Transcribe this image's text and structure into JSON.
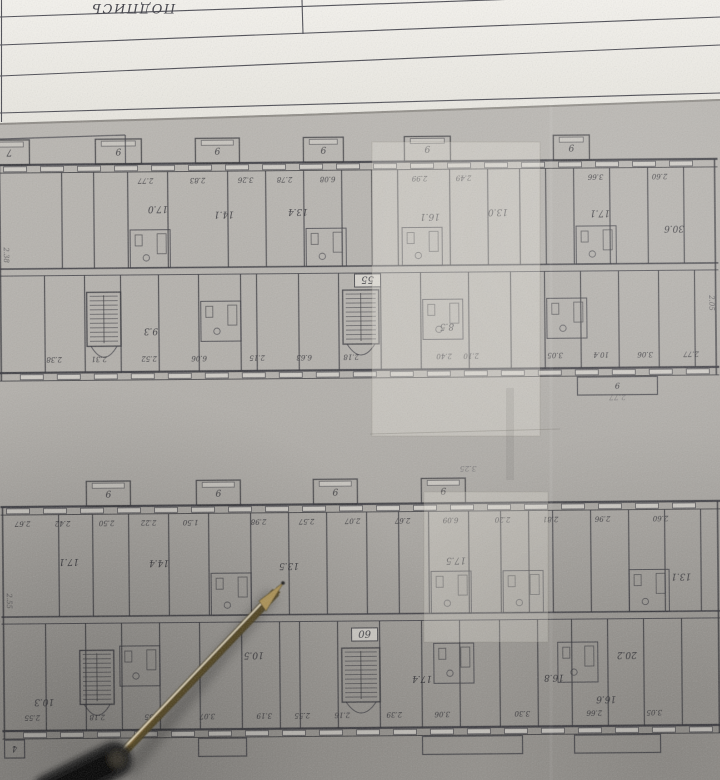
{
  "form_header": {
    "signature_label": "ПОДПИСЬ"
  },
  "colors": {
    "form_paper": "#f2f0ea",
    "photo_paper": "#b3b0ab",
    "ink": "#33333a",
    "patch": "#ece9e1",
    "pen_gold": "#c2a55e",
    "pen_grip": "#141414"
  },
  "plan": {
    "strips": [
      {
        "id": "upper",
        "y_top": 162,
        "y_mid": 266,
        "y_bottom": 370,
        "balconies_top": [
          {
            "x": -8,
            "w": 40,
            "label": "7"
          },
          {
            "x": 98,
            "w": 46,
            "label": "9"
          },
          {
            "x": 198,
            "w": 44,
            "label": "9"
          },
          {
            "x": 306,
            "w": 40,
            "label": "9"
          },
          {
            "x": 407,
            "w": 46,
            "label": "9"
          },
          {
            "x": 556,
            "w": 36,
            "label": "9"
          }
        ],
        "balconies_bottom": [
          {
            "x": 578,
            "w": 80,
            "label": "9"
          }
        ],
        "v_walls_upper": [
          64,
          96,
          130,
          170,
          230,
          268,
          306,
          344,
          374,
          400,
          452,
          490,
          522,
          548,
          576,
          612,
          650,
          686
        ],
        "v_walls_lower": [
          46,
          86,
          122,
          160,
          200,
          242,
          258,
          300,
          340,
          382,
          422,
          470,
          512,
          546,
          582,
          620,
          660,
          696
        ],
        "stairs": [
          {
            "x": 88,
            "y": 290,
            "w": 34,
            "h": 54
          },
          {
            "x": 344,
            "y": 290,
            "w": 36,
            "h": 54
          }
        ],
        "unit_box": {
          "x": 356,
          "y": 274,
          "w": 26,
          "h": 13,
          "label": "55"
        },
        "bath_clusters": [
          {
            "x": 132,
            "y": 228
          },
          {
            "x": 308,
            "y": 228
          },
          {
            "x": 404,
            "y": 228
          },
          {
            "x": 578,
            "y": 228
          },
          {
            "x": 202,
            "y": 300
          },
          {
            "x": 424,
            "y": 300
          },
          {
            "x": 548,
            "y": 300
          }
        ],
        "dim_labels_top": [
          {
            "x": 148,
            "t": "2.77"
          },
          {
            "x": 200,
            "t": "2.83"
          },
          {
            "x": 248,
            "t": "3.26"
          },
          {
            "x": 287,
            "t": "2.78"
          },
          {
            "x": 330,
            "t": "6.08"
          },
          {
            "x": 422,
            "t": "2.99"
          },
          {
            "x": 466,
            "t": "2.49"
          },
          {
            "x": 598,
            "t": "3.66"
          },
          {
            "x": 662,
            "t": "2.60"
          }
        ],
        "room_labels": [
          {
            "x": 160,
            "y": 208,
            "t": "17.0"
          },
          {
            "x": 226,
            "y": 214,
            "t": "14.1"
          },
          {
            "x": 300,
            "y": 212,
            "t": "13.4"
          },
          {
            "x": 432,
            "y": 218,
            "t": "16.1"
          },
          {
            "x": 500,
            "y": 214,
            "t": "13.0"
          },
          {
            "x": 602,
            "y": 216,
            "t": "17.1"
          },
          {
            "x": 676,
            "y": 232,
            "t": "30.6"
          },
          {
            "x": 152,
            "y": 330,
            "t": "9.3"
          },
          {
            "x": 448,
            "y": 328,
            "t": "8.5"
          }
        ],
        "dim_labels_bottom": [
          {
            "x": 55,
            "t": "2.38"
          },
          {
            "x": 100,
            "t": "2.31"
          },
          {
            "x": 150,
            "t": "2.52"
          },
          {
            "x": 200,
            "t": "6.06"
          },
          {
            "x": 258,
            "t": "2.15"
          },
          {
            "x": 305,
            "t": "6.63"
          },
          {
            "x": 352,
            "t": "2.18"
          },
          {
            "x": 445,
            "t": "2.40"
          },
          {
            "x": 472,
            "t": "2.10"
          },
          {
            "x": 556,
            "t": "3.05"
          },
          {
            "x": 602,
            "t": "10.4"
          },
          {
            "x": 646,
            "t": "3.06"
          },
          {
            "x": 692,
            "t": "2.77"
          }
        ]
      },
      {
        "id": "lower",
        "y_top": 504,
        "y_mid": 614,
        "y_bottom": 728,
        "balconies_top": [
          {
            "x": 86,
            "w": 44,
            "label": "9"
          },
          {
            "x": 196,
            "w": 44,
            "label": "9"
          },
          {
            "x": 313,
            "w": 44,
            "label": "9"
          },
          {
            "x": 421,
            "w": 44,
            "label": "9"
          }
        ],
        "balconies_bottom": [
          {
            "x": 2,
            "w": 20,
            "label": "4"
          },
          {
            "x": 196,
            "w": 48,
            "label": ""
          },
          {
            "x": 420,
            "w": 100,
            "label": ""
          },
          {
            "x": 572,
            "w": 86,
            "label": ""
          }
        ],
        "v_walls_upper": [
          58,
          92,
          128,
          168,
          208,
          250,
          288,
          326,
          366,
          398,
          428,
          468,
          500,
          528,
          552,
          590,
          628,
          664,
          700
        ],
        "v_walls_lower": [
          44,
          84,
          120,
          158,
          198,
          240,
          278,
          298,
          336,
          378,
          420,
          458,
          498,
          536,
          570,
          606,
          642,
          680
        ],
        "stairs": [
          {
            "x": 78,
            "y": 648,
            "w": 34,
            "h": 54
          },
          {
            "x": 340,
            "y": 648,
            "w": 38,
            "h": 54
          }
        ],
        "unit_box": {
          "x": 350,
          "y": 628,
          "w": 26,
          "h": 13,
          "label": "60"
        },
        "bath_clusters": [
          {
            "x": 210,
            "y": 572
          },
          {
            "x": 430,
            "y": 572
          },
          {
            "x": 502,
            "y": 572
          },
          {
            "x": 628,
            "y": 572
          },
          {
            "x": 118,
            "y": 644
          },
          {
            "x": 432,
            "y": 644
          },
          {
            "x": 556,
            "y": 644
          }
        ],
        "dim_labels_top": [
          {
            "x": 22,
            "t": "2.67"
          },
          {
            "x": 62,
            "t": "2.42"
          },
          {
            "x": 106,
            "t": "2.50"
          },
          {
            "x": 148,
            "t": "2.22"
          },
          {
            "x": 190,
            "t": "1.50"
          },
          {
            "x": 258,
            "t": "2.98"
          },
          {
            "x": 306,
            "t": "2.57"
          },
          {
            "x": 352,
            "t": "2.07"
          },
          {
            "x": 402,
            "t": "2.67"
          },
          {
            "x": 450,
            "t": "6.09"
          },
          {
            "x": 502,
            "t": "2.20"
          },
          {
            "x": 550,
            "t": "2.81"
          },
          {
            "x": 602,
            "t": "2.96"
          },
          {
            "x": 660,
            "t": "2.60"
          }
        ],
        "room_labels": [
          {
            "x": 68,
            "y": 560,
            "t": "17.1"
          },
          {
            "x": 158,
            "y": 562,
            "t": "14.4"
          },
          {
            "x": 288,
            "y": 566,
            "t": "13.5"
          },
          {
            "x": 455,
            "y": 562,
            "t": "17.5"
          },
          {
            "x": 680,
            "y": 580,
            "t": "13.1"
          },
          {
            "x": 252,
            "y": 655,
            "t": "10.5"
          },
          {
            "x": 420,
            "y": 680,
            "t": "17.4"
          },
          {
            "x": 552,
            "y": 680,
            "t": "16.8"
          },
          {
            "x": 625,
            "y": 658,
            "t": "20.2"
          },
          {
            "x": 604,
            "y": 702,
            "t": "16.6"
          },
          {
            "x": 42,
            "y": 700,
            "t": "10.3"
          }
        ],
        "dim_labels_bottom": [
          {
            "x": 30,
            "t": "2.55"
          },
          {
            "x": 95,
            "t": "2.18"
          },
          {
            "x": 150,
            "t": "1.55"
          },
          {
            "x": 205,
            "t": "3.07"
          },
          {
            "x": 262,
            "t": "3.19"
          },
          {
            "x": 300,
            "t": "2.55"
          },
          {
            "x": 340,
            "t": "2.16"
          },
          {
            "x": 392,
            "t": "2.39"
          },
          {
            "x": 440,
            "t": "3.06"
          },
          {
            "x": 520,
            "t": "3.30"
          },
          {
            "x": 592,
            "t": "2.66"
          },
          {
            "x": 652,
            "t": "3.05"
          }
        ]
      }
    ],
    "edge_labels": [
      {
        "x": 8,
        "y": 252,
        "t": "2.38",
        "rot": 90
      },
      {
        "x": 8,
        "y": 598,
        "t": "2.55",
        "rot": 90
      },
      {
        "x": 713,
        "y": 306,
        "t": "2.05",
        "rot": 90
      }
    ],
    "gap_labels": [
      {
        "x": 468,
        "y": 470,
        "t": "3.25"
      },
      {
        "x": 618,
        "y": 400,
        "t": "2.77"
      }
    ]
  }
}
